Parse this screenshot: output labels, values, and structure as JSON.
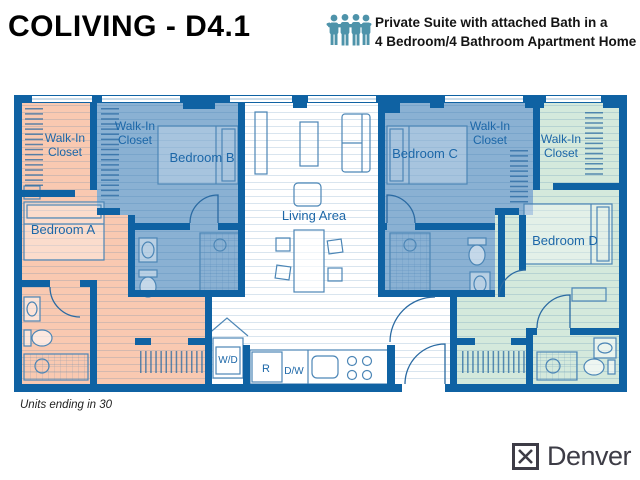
{
  "header": {
    "title": "COLIVING - D4.1",
    "tagline": {
      "line1": "Private Suite with attached Bath in a",
      "line2": "4 Bedroom/4 Bathroom Apartment Home"
    }
  },
  "floor_plan": {
    "labels": {
      "walk_in_line1": "Walk-In",
      "walk_in_line2": "Closet",
      "bedroom_a": "Bedroom A",
      "bedroom_b": "Bedroom B",
      "bedroom_c": "Bedroom C",
      "bedroom_d": "Bedroom D",
      "living_area": "Living Area",
      "washer_dryer": "W/D",
      "refrigerator": "R",
      "dishwasher": "D/W"
    },
    "colors": {
      "wall": "#0f62a3",
      "suite_a": "#f9c9b1",
      "suite_b": "#8ab1d3",
      "suite_c": "#8ab1d3",
      "suite_d": "#d4e9dc",
      "common_floor": "#ffffff",
      "label_text": "#1c67a8",
      "furniture_line": "#4c86b6",
      "people_icon": "#4e93aa"
    }
  },
  "footer": {
    "note": "Units ending in 30",
    "brand": "Denver"
  }
}
